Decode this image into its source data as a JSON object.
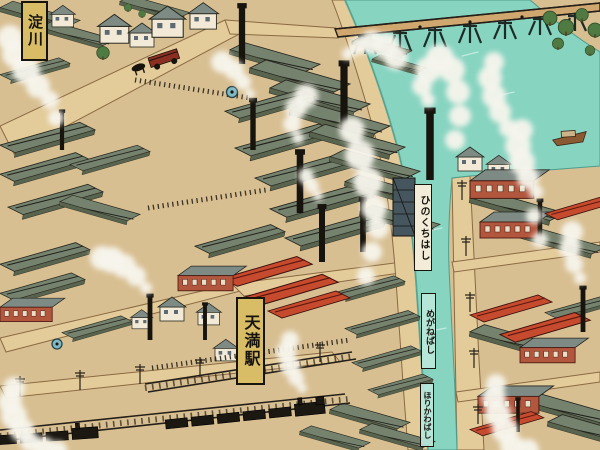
{
  "map": {
    "labels": {
      "river": "淀川",
      "station": "天満駅",
      "bridge_upper": "ひのくちはし",
      "bridge_middle": "めがねばし",
      "bridge_lower": "ほりかわばし"
    },
    "colors": {
      "paper_tan": "#d8bf92",
      "water_teal": "#87d4c1",
      "roof_slate": "#75826e",
      "brick_red": "#b2563e",
      "roof_red_orange": "#c64a2e",
      "banner_gold": "#d9bd66",
      "smoke_white": "#f7f4ec",
      "ink": "#17140e"
    },
    "scene_features": [
      "bird's-eye pictorial map",
      "railway trestle bridge over river",
      "canal with three labeled bridges",
      "factory district with smoking chimneys",
      "red brick factory buildings",
      "tiled row houses",
      "steam trains on railway",
      "horse-drawn tram",
      "boat on river",
      "telegraph poles",
      "trees on river bank",
      "tram stop markers"
    ]
  }
}
